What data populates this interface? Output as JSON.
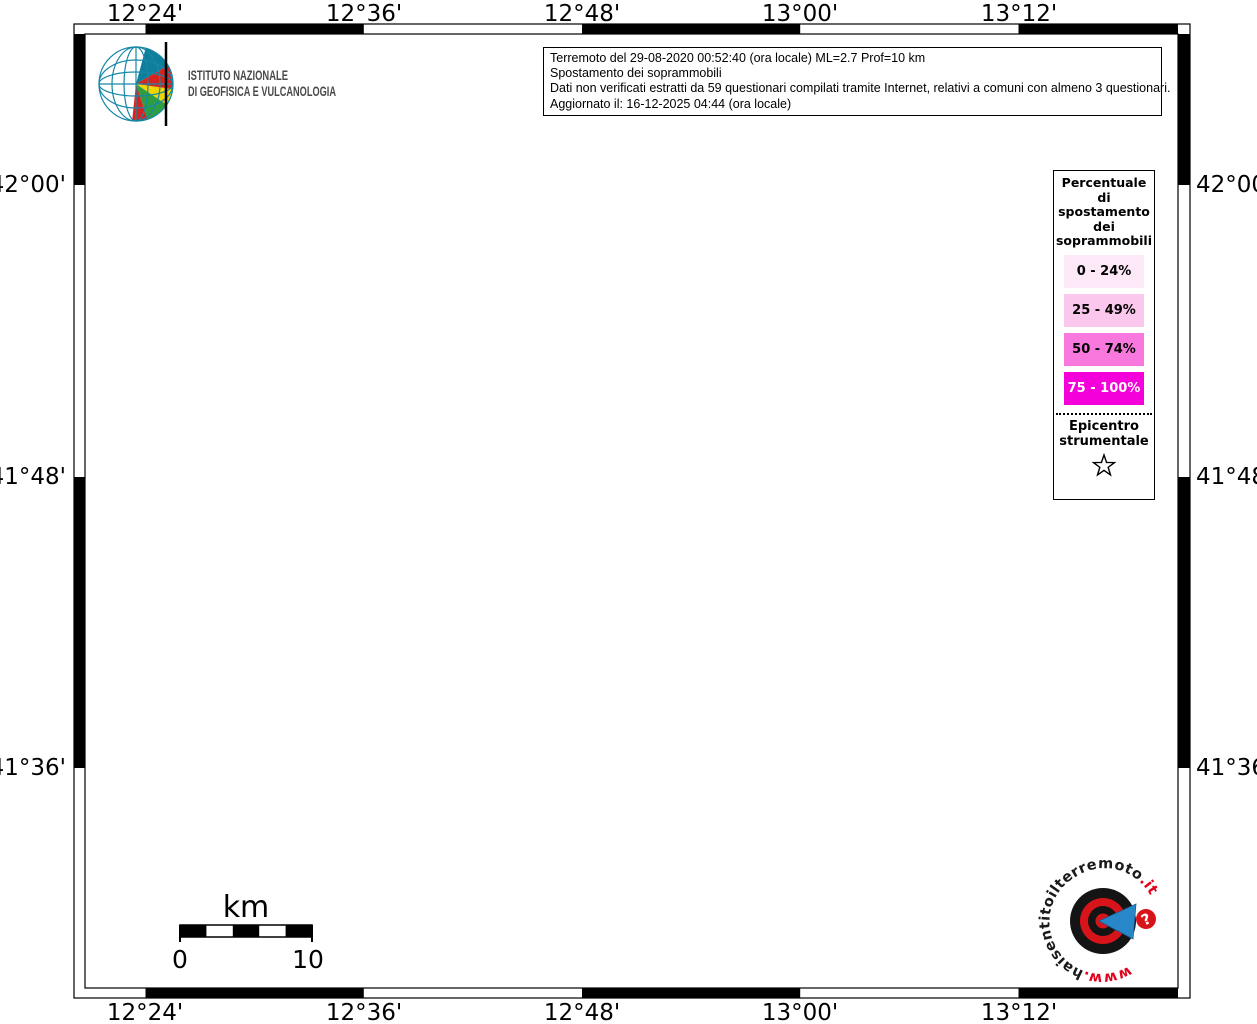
{
  "title_box": {
    "line1": "Terremoto del 29-08-2020 00:52:40 (ora locale) ML=2.7 Prof=10 km",
    "line2": "Spostamento dei soprammobili",
    "line3": "Dati non verificati estratti da 59 questionari compilati tramite Internet, relativi a comuni con almeno 3 questionari.",
    "line4": "Aggiornato il: 16-12-2025 04:44 (ora locale)"
  },
  "legend": {
    "title_lines": [
      "Percentuale",
      "di",
      "spostamento",
      "dei",
      "soprammobili"
    ],
    "classes": [
      {
        "label": "0 - 24%",
        "color": "#fce8f6",
        "text": "#000000"
      },
      {
        "label": "25 - 49%",
        "color": "#fbc7ec",
        "text": "#000000"
      },
      {
        "label": "50 - 74%",
        "color": "#f878de",
        "text": "#000000"
      },
      {
        "label": "75 - 100%",
        "color": "#f400da",
        "text": "#ffffff"
      }
    ],
    "epicenter_lines": [
      "Epicentro",
      "strumentale"
    ]
  },
  "axes": {
    "lon": [
      "12°24'",
      "12°36'",
      "12°48'",
      "13°00'",
      "13°12'"
    ],
    "lat": [
      "42°00'",
      "41°48'",
      "41°36'"
    ]
  },
  "scalebar": {
    "unit": "km",
    "start": "0",
    "end": "10"
  },
  "ingv_logo": {
    "line1": "ISTITUTO NAZIONALE",
    "line2": "DI GEOFISICA E VULCANOLOGIA"
  },
  "hsit_logo": {
    "prefix": "www.",
    "name": "haisentitoilterremoto",
    "tld": ".it",
    "badge": "?"
  },
  "map": {
    "sea_color": "#d6ebf7",
    "land_color": "#ffffff",
    "class1_color": "#fbe3f3",
    "class2_color": "#f9c3e9",
    "class3_color": "#f471da",
    "boundary_color": "#bdbdbd",
    "grid_color": "#3a3a3a",
    "coast_color": "#5f7280",
    "lake_color": "#d9edf8",
    "lake_stroke": "#4f7fae",
    "accent_red": "#d7141a",
    "accent_blue": "#2787c8"
  }
}
